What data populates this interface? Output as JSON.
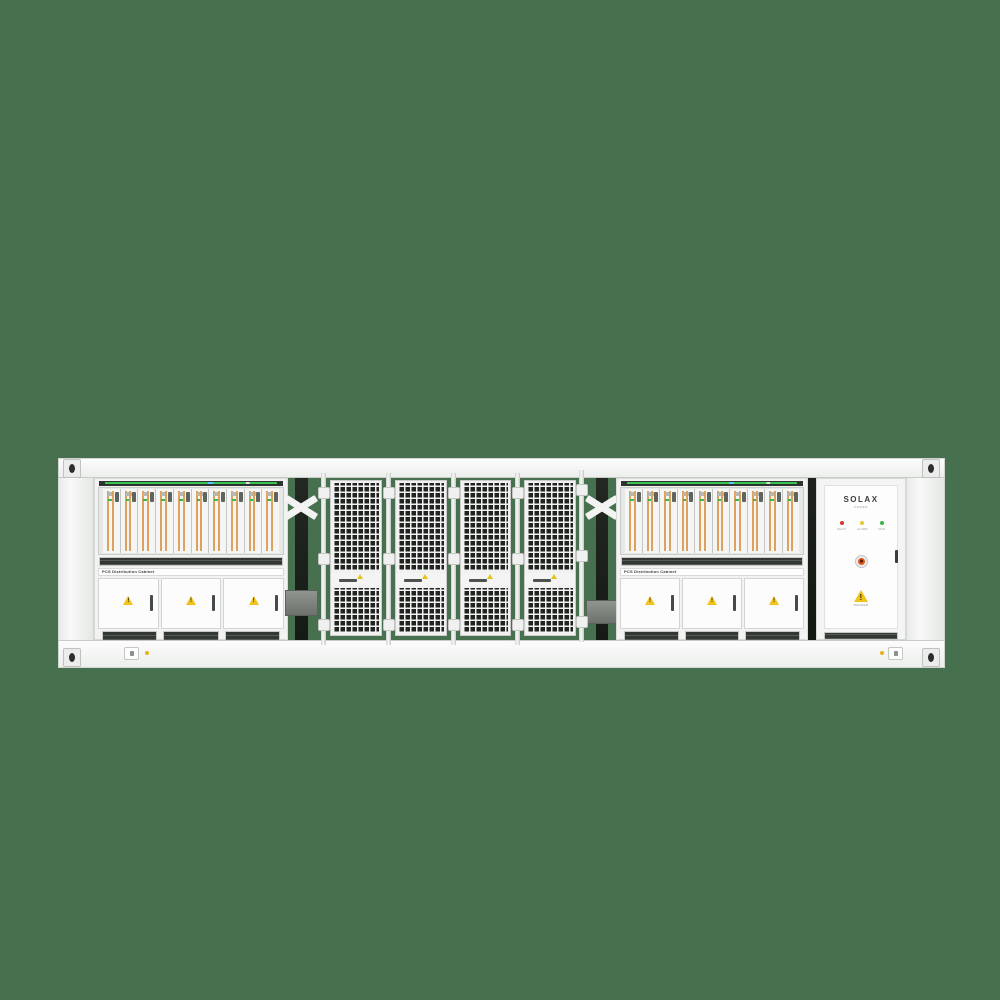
{
  "scene": {
    "description": "Front view render of a white containerized battery energy storage system on a green background",
    "background_color": "#47704F",
    "container_color": "#f4f5f4"
  },
  "pcs_left": {
    "label": "PCS Distribution Cabinet",
    "module_count": 10,
    "door_count": 3
  },
  "pcs_right": {
    "label": "PCS Distribution Cabinet",
    "module_count": 10,
    "door_count": 3
  },
  "battery_bay": {
    "mesh_door_count": 4,
    "mesh_color": "#212321"
  },
  "solax_cabinet": {
    "brand": "SOLAX",
    "brand_sub": "POWER",
    "leds": [
      {
        "label": "FAULT",
        "color": "#d33a2c"
      },
      {
        "label": "ALARM",
        "color": "#e8c832"
      },
      {
        "label": "RUN",
        "color": "#3cb54a"
      }
    ],
    "warning_label": "DANGER"
  },
  "accents": {
    "module_stripe": "#dda35e",
    "warning_yellow": "#f2c21c",
    "led_green": "#35c24f"
  }
}
